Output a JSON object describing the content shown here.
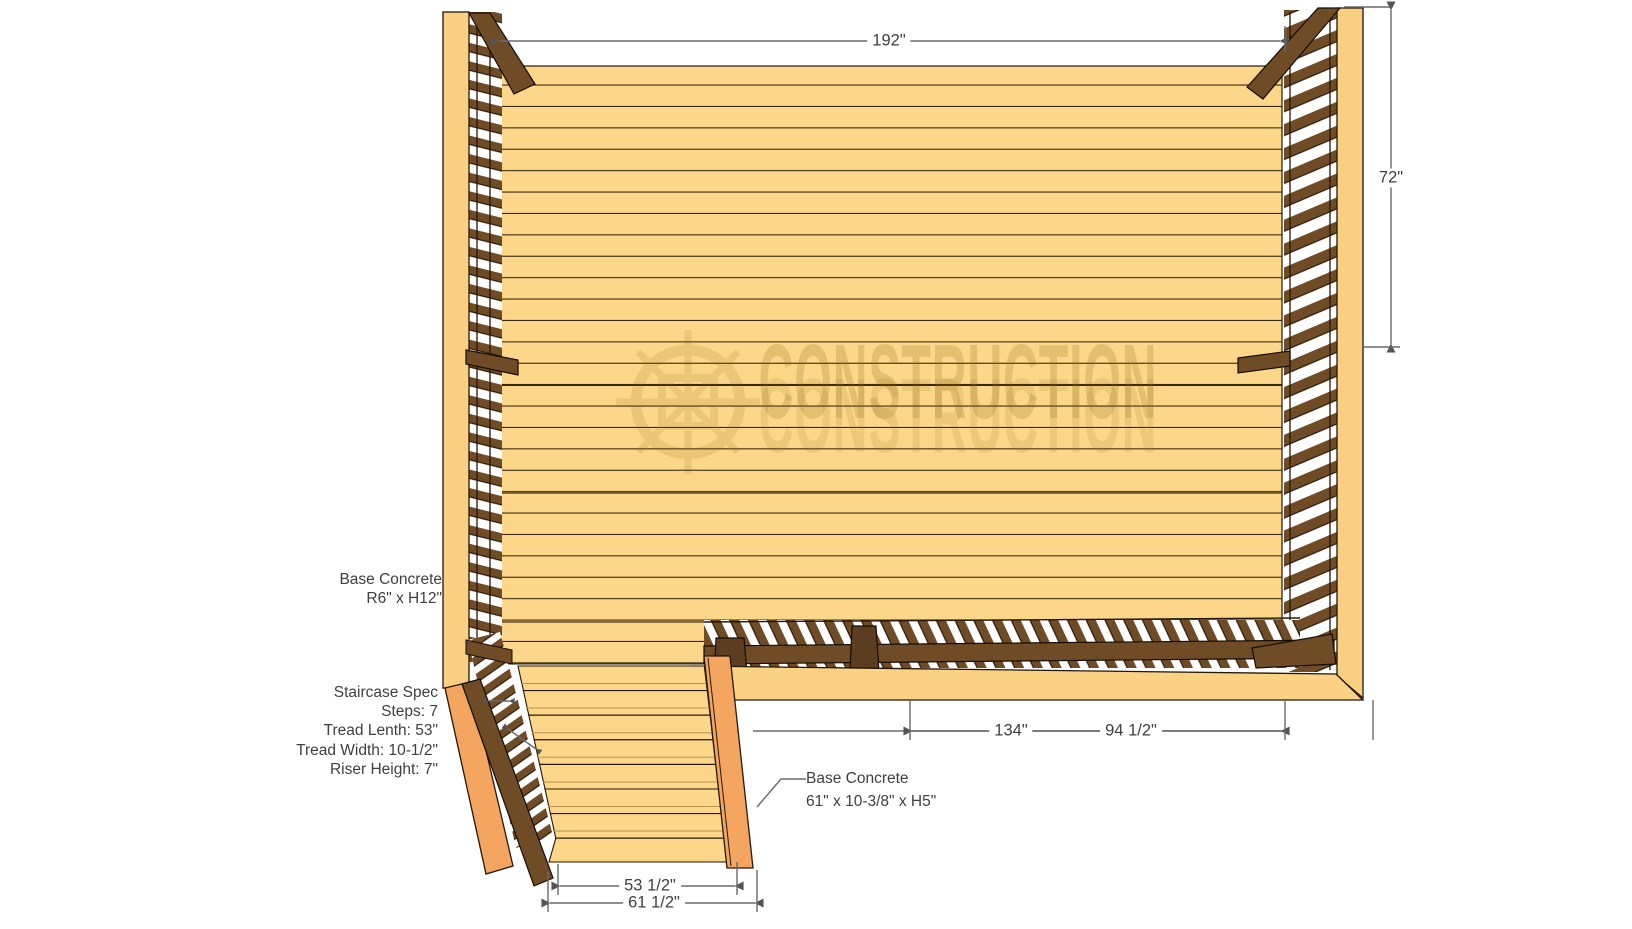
{
  "drawing": {
    "title": "Deck with staircase construction plan",
    "watermark_text": "CONSTRUCTION"
  },
  "dimensions": {
    "deck_width": "192\"",
    "deck_side_height": "72\"",
    "bottom_run_a": "134\"",
    "bottom_run_b": "94 1/2\"",
    "stair_tread_run": "53 1/2\"",
    "stair_base_run": "61 1/2\""
  },
  "annotations": {
    "base_concrete_post": {
      "lines": [
        "Base Concrete",
        "R6\" x H12\""
      ]
    },
    "staircase_spec": {
      "lines": [
        "Staircase Spec",
        "Steps: 7",
        "Tread Lenth: 53\"",
        "Tread Width: 10-1/2\"",
        "Riser Height: 7\""
      ]
    },
    "base_concrete_stairs": {
      "lines": [
        "Base Concrete",
        "61\" x 10-3/8\" x H5\""
      ]
    }
  },
  "colors": {
    "deck_board": "#fcd789",
    "trim_light": "#fbcf82",
    "stringer_orange": "#f4a55f",
    "rail_dark": "#6f4b26",
    "outline": "#241708",
    "dimension_gray": "#5f5f5f",
    "label_text": "#3f3f3f",
    "watermark": "#8a6510"
  }
}
